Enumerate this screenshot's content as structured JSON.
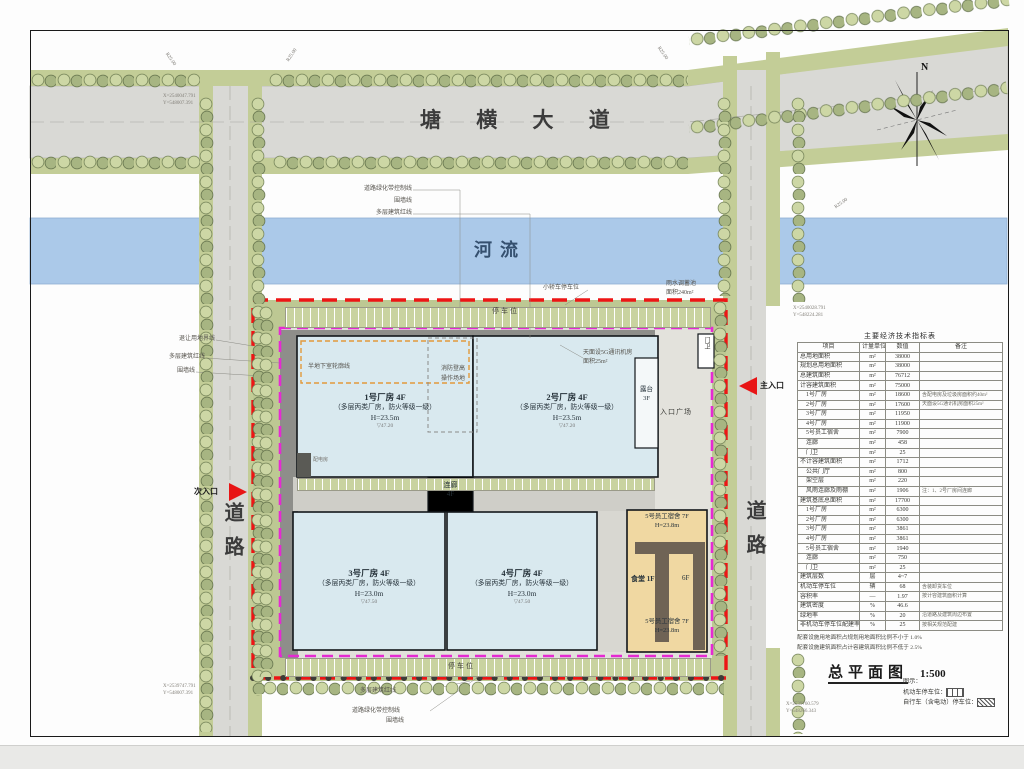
{
  "roads": {
    "main": "塘 横 大 道",
    "river": "河流",
    "left": "道路",
    "right": "道路",
    "north": "N"
  },
  "entrances": {
    "main": "主入口",
    "secondary": "次入口"
  },
  "buildings": {
    "b1": {
      "name": "1号厂房 4F",
      "spec": "（多层丙类厂房，防火等级一级）",
      "height": "H=23.5m",
      "elev": "▽47.20"
    },
    "b2": {
      "name": "2号厂房 4F",
      "spec": "（多层丙类厂房，防火等级一级）",
      "height": "H=23.5m",
      "elev": "▽47.20"
    },
    "b3": {
      "name": "3号厂房 4F",
      "spec": "（多层丙类厂房，防火等级一级）",
      "height": "H=23.0m",
      "elev": "▽47.50"
    },
    "b4": {
      "name": "4号厂房 4F",
      "spec": "（多层丙类厂房，防火等级一级）",
      "height": "H=23.0m",
      "elev": "▽47.50"
    },
    "corridor": {
      "name": "连廊",
      "floors": "4F"
    },
    "terrace": {
      "name": "露台",
      "floors": "3F"
    },
    "dorm_top": {
      "name": "5号员工宿舍 7F",
      "height": "H=23.8m"
    },
    "canteen": {
      "name": "食堂 1F",
      "right": "6F"
    },
    "dorm_bottom": {
      "name": "5号员工宿舍 7F",
      "height": "H=23.8m"
    },
    "gatehouse": "门卫",
    "plaza": "入口广场"
  },
  "annotations": {
    "top_lines": [
      "道路绿化带控制线",
      "围墙线",
      "多层建筑红线"
    ],
    "left_lines": [
      "退让用地界线",
      "多层建筑红线",
      "围墙线"
    ],
    "bottom_lines": [
      "多层建筑红线",
      "道路绿化带控制线",
      "围墙线"
    ],
    "parking_note": "小轿车停车位",
    "pond_note_1": "雨水调蓄池",
    "pond_note_2": "面积240m²",
    "roof_note_1": "天面设5G通讯机房",
    "roof_note_2": "面积25m²",
    "fire_box_1": "消防登高",
    "fire_box_2": "操作场地",
    "basement_note": "半地下室轮廓线",
    "substation": "配电房",
    "parking_label": "停车位",
    "radius_label": "R25.00"
  },
  "coords": {
    "tl_x": "X=2540047.791",
    "tl_y": "Y=548007.391",
    "r1_x": "X=2540028.791",
    "r1_y": "Y=548224.281",
    "bl_x": "X=2539747.791",
    "bl_y": "Y=548007.391",
    "br_x": "X=2539760.579",
    "br_y": "Y=548266.343"
  },
  "table": {
    "title": "主要经济技术指标表",
    "columns": [
      "项目",
      "计量单位",
      "数值",
      "备注"
    ],
    "rows": [
      [
        "总用地面积",
        "m²",
        "38000",
        ""
      ],
      [
        "规划总用地面积",
        "m²",
        "38000",
        ""
      ],
      [
        "总建筑面积",
        "m²",
        "76712",
        ""
      ],
      [
        "计容建筑面积",
        "m²",
        "75000",
        ""
      ],
      [
        "　1号厂房",
        "m²",
        "18600",
        "含配电房及垃圾房面积约40m²"
      ],
      [
        "　2号厂房",
        "m²",
        "17600",
        "天面设5G通讯机房面积25m²"
      ],
      [
        "　3号厂房",
        "m²",
        "11950",
        ""
      ],
      [
        "　4号厂房",
        "m²",
        "11900",
        ""
      ],
      [
        "　5号员工宿舍",
        "m²",
        "7900",
        ""
      ],
      [
        "　连廊",
        "m²",
        "458",
        ""
      ],
      [
        "　门卫",
        "m²",
        "25",
        ""
      ],
      [
        "不计容建筑面积",
        "m²",
        "1712",
        ""
      ],
      [
        "　公共门厅",
        "m²",
        "800",
        ""
      ],
      [
        "　架空层",
        "m²",
        "220",
        ""
      ],
      [
        "　风雨连廊及雨棚",
        "m²",
        "1906",
        "注：1、2号厂房间连廊"
      ],
      [
        "建筑基底总面积",
        "m²",
        "17700",
        ""
      ],
      [
        "　1号厂房",
        "m²",
        "6300",
        ""
      ],
      [
        "　2号厂房",
        "m²",
        "6300",
        ""
      ],
      [
        "　3号厂房",
        "m²",
        "3861",
        ""
      ],
      [
        "　4号厂房",
        "m²",
        "3861",
        ""
      ],
      [
        "　5号员工宿舍",
        "m²",
        "1940",
        ""
      ],
      [
        "　连廊",
        "m²",
        "750",
        ""
      ],
      [
        "　门卫",
        "m²",
        "25",
        ""
      ],
      [
        "建筑层数",
        "层",
        "4~7",
        ""
      ],
      [
        "机动车停车位",
        "辆",
        "68",
        "含装卸货车位"
      ],
      [
        "容积率",
        "—",
        "1.97",
        "按计容建筑面积计算"
      ],
      [
        "建筑密度",
        "%",
        "46.6",
        ""
      ],
      [
        "绿地率",
        "%",
        "20",
        "沿道路及建筑周边布置"
      ],
      [
        "非机动车停车位配建率",
        "%",
        "25",
        "按相关规范配建"
      ]
    ],
    "notes": [
      "配套设施用地面积占规划用地面积比例不小于 1.0%",
      "配套设施建筑面积占计容建筑面积比例不低于 2.5%"
    ]
  },
  "title_block": {
    "title": "总平面图",
    "scale": "1:500"
  },
  "legend": {
    "heading": "图示：",
    "car": "机动车停车位：",
    "bike": "自行车（含电动）停车位："
  }
}
